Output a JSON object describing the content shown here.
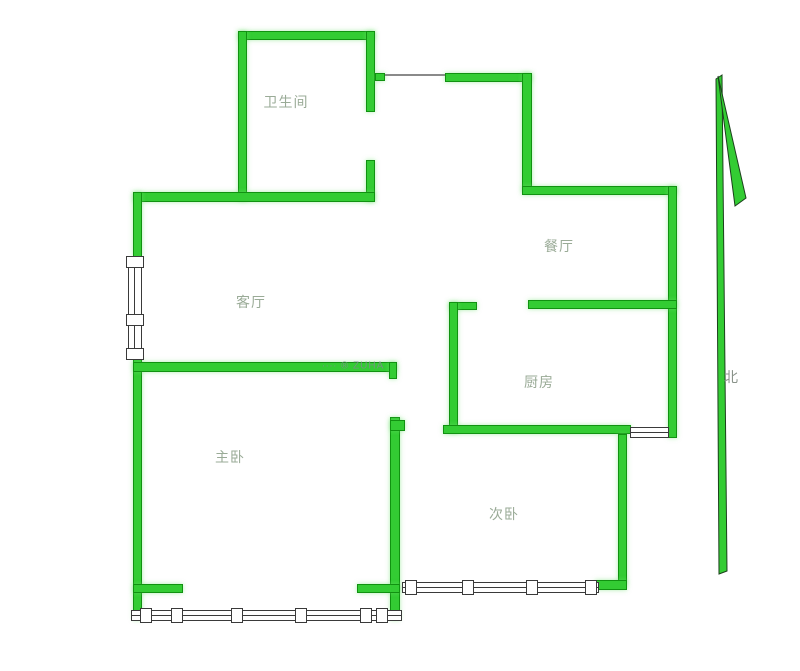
{
  "page": {
    "title": "户型图",
    "background": "#ffffff"
  },
  "colors": {
    "wall_fill": "#33cc33",
    "wall_edge": "#119211",
    "window_edge": "#3a3a3a",
    "room_label": "#9aab97",
    "compass_label": "#8a938a",
    "arrow_outline": "#1c401c"
  },
  "rooms": [
    {
      "id": "bathroom",
      "label": "卫生间",
      "x": 286,
      "y": 102
    },
    {
      "id": "dining-room",
      "label": "餐厅",
      "x": 559,
      "y": 246
    },
    {
      "id": "living-room",
      "label": "客厅",
      "x": 251,
      "y": 302
    },
    {
      "id": "kitchen",
      "label": "厨房",
      "x": 539,
      "y": 382
    },
    {
      "id": "master-bedroom",
      "label": "主卧",
      "x": 230,
      "y": 457
    },
    {
      "id": "second-bedroom",
      "label": "次卧",
      "x": 504,
      "y": 514
    }
  ],
  "compass": {
    "label": "北",
    "x": 731,
    "y": 377
  },
  "watermark": {
    "text": "∙∙∙∙ ® ZUHA",
    "x": 322,
    "y": 366
  },
  "plan": {
    "walls": [
      {
        "name": "bathroom-north-wall",
        "x": 238,
        "y": 31,
        "w": 137,
        "h": 9
      },
      {
        "name": "bathroom-west-wall",
        "x": 238,
        "y": 31,
        "w": 9,
        "h": 170
      },
      {
        "name": "bathroom-east-wall-upper",
        "x": 366,
        "y": 31,
        "w": 9,
        "h": 81
      },
      {
        "name": "bathroom-door-stub",
        "x": 375,
        "y": 73,
        "w": 10,
        "h": 8
      },
      {
        "name": "bathroom-east-wall-lower",
        "x": 366,
        "y": 160,
        "w": 9,
        "h": 42
      },
      {
        "name": "entry-north-wall",
        "x": 445,
        "y": 73,
        "w": 87,
        "h": 9
      },
      {
        "name": "dining-west-wall",
        "x": 522,
        "y": 73,
        "w": 10,
        "h": 118
      },
      {
        "name": "dining-north-wall",
        "x": 522,
        "y": 186,
        "w": 155,
        "h": 9
      },
      {
        "name": "east-exterior-wall",
        "x": 668,
        "y": 186,
        "w": 9,
        "h": 252
      },
      {
        "name": "living-north-wall",
        "x": 133,
        "y": 192,
        "w": 242,
        "h": 10
      },
      {
        "name": "west-exterior-wall-upper",
        "x": 133,
        "y": 192,
        "w": 9,
        "h": 65
      },
      {
        "name": "west-exterior-wall-lower",
        "x": 133,
        "y": 358,
        "w": 9,
        "h": 262
      },
      {
        "name": "living-south-wall",
        "x": 133,
        "y": 362,
        "w": 264,
        "h": 10
      },
      {
        "name": "living-south-hook",
        "x": 389,
        "y": 362,
        "w": 8,
        "h": 17
      },
      {
        "name": "kitchen-north-stub",
        "x": 449,
        "y": 302,
        "w": 28,
        "h": 8
      },
      {
        "name": "kitchen-west-wall",
        "x": 449,
        "y": 302,
        "w": 9,
        "h": 131
      },
      {
        "name": "kitchen-north-wall",
        "x": 528,
        "y": 300,
        "w": 149,
        "h": 9
      },
      {
        "name": "bedroom2-north-wall",
        "x": 443,
        "y": 425,
        "w": 188,
        "h": 9
      },
      {
        "name": "bedroom-divider-wall",
        "x": 390,
        "y": 417,
        "w": 10,
        "h": 203
      },
      {
        "name": "bedroom-divider-hook",
        "x": 390,
        "y": 420,
        "w": 15,
        "h": 11
      },
      {
        "name": "bedroom2-east-wall",
        "x": 618,
        "y": 434,
        "w": 9,
        "h": 150
      },
      {
        "name": "bedroom2-south-wall",
        "x": 595,
        "y": 580,
        "w": 32,
        "h": 10
      },
      {
        "name": "bedroom1-south-stub-left",
        "x": 133,
        "y": 584,
        "w": 50,
        "h": 9
      },
      {
        "name": "bedroom1-south-stub-right",
        "x": 357,
        "y": 584,
        "w": 43,
        "h": 9
      }
    ],
    "windows": [
      {
        "name": "living-room-window",
        "x": 128,
        "y": 256,
        "w": 14,
        "h": 104,
        "dir": "v",
        "mullions": [
          0,
          58,
          92
        ]
      },
      {
        "name": "kitchen-window",
        "x": 630,
        "y": 427,
        "w": 39,
        "h": 11,
        "dir": "h",
        "mullions": []
      },
      {
        "name": "bedroom2-bay-window",
        "x": 402,
        "y": 582,
        "w": 197,
        "h": 11,
        "dir": "h",
        "mullions": [
          3,
          60,
          124,
          183
        ]
      },
      {
        "name": "bedroom1-bay-window",
        "x": 131,
        "y": 610,
        "w": 271,
        "h": 11,
        "dir": "h",
        "mullions": [
          9,
          40,
          100,
          164,
          229,
          245
        ]
      }
    ],
    "door_lines": [
      {
        "name": "entry-door-header",
        "x": 385,
        "y": 74,
        "len": 60,
        "dir": "h"
      }
    ],
    "arrow": {
      "shaft_points": "716,79 722,75 727,571 719,574",
      "barb_points": "718,76 746,198 735,206"
    }
  }
}
